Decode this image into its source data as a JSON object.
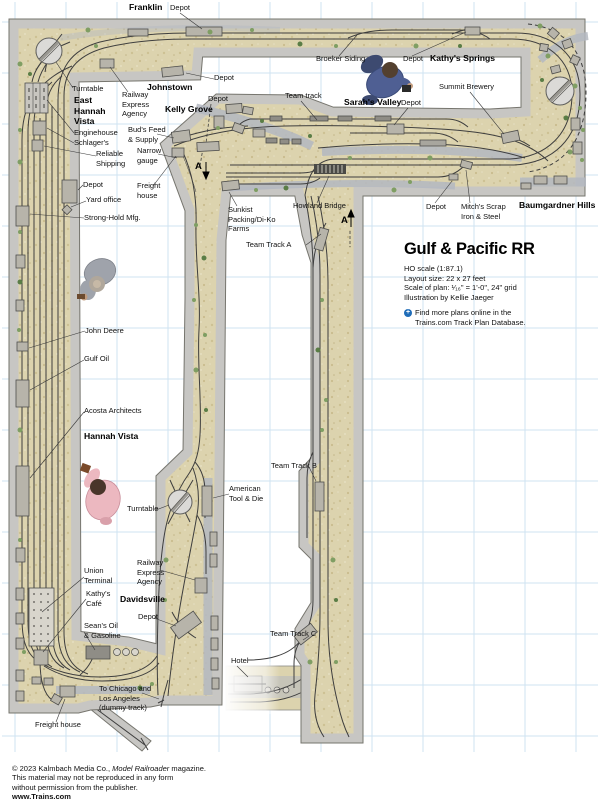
{
  "title_block": {
    "title": "Gulf & Pacific RR",
    "ho_scale": "HO scale (1:87.1)",
    "layout_size": "Layout size: 22 x 27 feet",
    "scale_plan": "Scale of plan: ¹⁄₁₆\" = 1'-0\", 24\" grid",
    "illustration": "Illustration by Kellie Jaeger",
    "find_more_line1": "Find more plans online in the",
    "find_more_line2": "Trains.com Track Plan Database.",
    "icon": "plus-circle-icon"
  },
  "labels": {
    "franklin": "Franklin",
    "depot_franklin": "Depot",
    "turntable_top": "Turntable",
    "east_hannah_vista": "East\nHannah\nVista",
    "railway_express_top": "Railway\nExpress\nAgency",
    "johnstown": "Johnstown",
    "kelly_grove": "Kelly Grove",
    "depot_johnstown": "Depot",
    "depot_kelly_grove": "Depot",
    "buds_feed": "Bud's Feed\n& Supply",
    "narrow_gauge": "Narrow\ngauge",
    "freight_house_top": "Freight\nhouse",
    "team_track": "Team track",
    "broeker_siding": "Broeker Siding",
    "depot_broeker": "Depot",
    "kathys_springs": "Kathy's Springs",
    "sarahs_valley": "Sarah's Valley",
    "depot_sarahs": "Depot",
    "summit_brewery": "Summit Brewery",
    "baumgardner_hills": "Baumgardner Hills",
    "mitchs_scrap": "Mitch's Scrap\nIron & Steel",
    "depot_mitch": "Depot",
    "howland_bridge": "Howland Bridge",
    "sunkist": "Sunkist\nPacking/Di-Ko\nFarms",
    "team_track_a": "Team Track A",
    "team_track_b": "Team Track B",
    "team_track_c": "Team Track C",
    "section_a1": "A",
    "section_a2": "A",
    "enginehouse": "Enginehouse",
    "schlagers": "Schlager's",
    "reliable_shipping": "Reliable\nShipping",
    "depot_yard": "Depot",
    "yard_office": "Yard office",
    "strong_hold": "Strong-Hold Mfg.",
    "john_deere": "John Deere",
    "gulf_oil": "Gulf Oil",
    "acosta": "Acosta Architects",
    "hannah_vista": "Hannah Vista",
    "american_tool": "American\nTool & Die",
    "turntable_bottom": "Turntable",
    "union_terminal": "Union\nTerminal",
    "kathys_cafe": "Kathy's\nCafé",
    "railway_express_bottom": "Railway\nExpress\nAgency",
    "davidsville": "Davidsville",
    "depot_davidsville": "Depot",
    "seans_oil": "Sean's Oil\n& Gasoline",
    "team_track_c2": "Team Track C",
    "hotel": "Hotel",
    "to_chicago": "To Chicago and\nLos Angeles\n(dummy track)",
    "freight_house_bottom": "Freight house"
  },
  "copyright": {
    "line1_prefix": "© 2023 Kalmbach Media Co., ",
    "line1_italic": "Model Railroader",
    "line1_suffix": " magazine.",
    "line2": "This material may not be reproduced in any form",
    "line3": "without permission from the publisher.",
    "line4": "www.Trains.com"
  },
  "colors": {
    "terrain": "#dcd3ae",
    "benchwork": "#c7c6c3",
    "grid": "#cfe3f2",
    "track": "#3e3e3e",
    "road": "#b4b8c1",
    "accent_blue": "#1f6cb8"
  }
}
